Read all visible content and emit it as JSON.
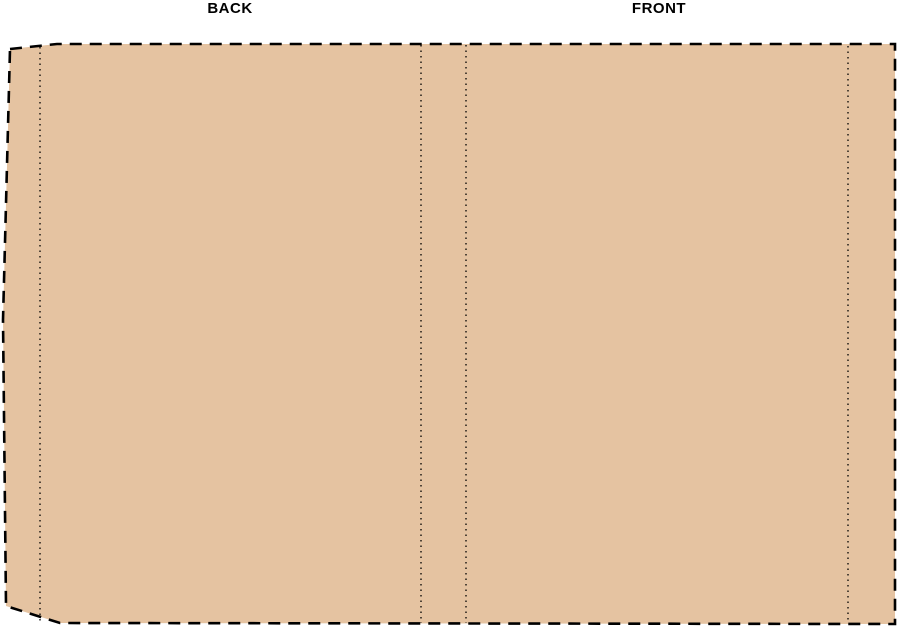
{
  "labels": {
    "back": "BACK",
    "front": "FRONT"
  },
  "colors": {
    "panel_fill": "#E5C3A1",
    "line": "#000000",
    "background": "#FFFFFF"
  }
}
